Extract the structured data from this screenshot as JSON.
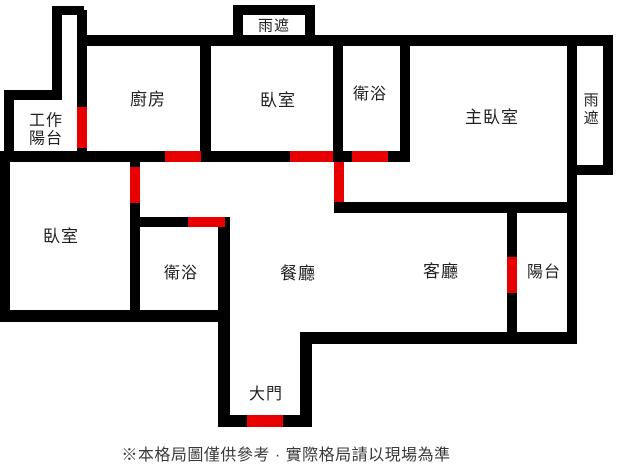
{
  "colors": {
    "wall": "#000000",
    "door_marker": "#e80000",
    "label": "#222222",
    "footer": "#3a3a3a",
    "background": "#ffffff"
  },
  "footer": {
    "note": "※本格局圖僅供參考 · 實際格局請以現場為準"
  },
  "rooms": [
    {
      "id": "work-balcony",
      "label": "工作陽台",
      "cx": 46,
      "cy": 131,
      "font": 16,
      "style": "wrap2"
    },
    {
      "id": "kitchen",
      "label": "廚房",
      "cx": 148,
      "cy": 100,
      "font": 17,
      "style": ""
    },
    {
      "id": "bedroom-top",
      "label": "臥室",
      "cx": 278,
      "cy": 101,
      "font": 17,
      "style": ""
    },
    {
      "id": "bathroom-top",
      "label": "衛浴",
      "cx": 370,
      "cy": 95,
      "font": 16,
      "style": ""
    },
    {
      "id": "master-bedroom",
      "label": "主臥室",
      "cx": 492,
      "cy": 118,
      "font": 17,
      "style": ""
    },
    {
      "id": "rain-canopy-top",
      "label": "雨遮",
      "cx": 274,
      "cy": 26,
      "font": 15,
      "style": ""
    },
    {
      "id": "rain-canopy-right",
      "label": "雨遮",
      "cx": 590,
      "cy": 110,
      "font": 15,
      "style": "vertical"
    },
    {
      "id": "bedroom-left",
      "label": "臥室",
      "cx": 61,
      "cy": 237,
      "font": 17,
      "style": ""
    },
    {
      "id": "bathroom-left",
      "label": "衛浴",
      "cx": 181,
      "cy": 274,
      "font": 16,
      "style": ""
    },
    {
      "id": "dining-room",
      "label": "餐廳",
      "cx": 298,
      "cy": 274,
      "font": 17,
      "style": ""
    },
    {
      "id": "living-room",
      "label": "客廳",
      "cx": 441,
      "cy": 272,
      "font": 17,
      "style": ""
    },
    {
      "id": "balcony",
      "label": "陽台",
      "cx": 544,
      "cy": 273,
      "font": 16,
      "style": ""
    },
    {
      "id": "main-door",
      "label": "大門",
      "cx": 266,
      "cy": 395,
      "font": 16,
      "style": ""
    }
  ],
  "walls": [
    {
      "id": "shaft-top",
      "x": 52,
      "y": 6,
      "w": 32,
      "h": 9
    },
    {
      "id": "shaft-left",
      "x": 52,
      "y": 6,
      "w": 10,
      "h": 94
    },
    {
      "id": "kitchen-left",
      "x": 77,
      "y": 10,
      "w": 10,
      "h": 152
    },
    {
      "id": "work-balcony-top",
      "x": 13,
      "y": 90,
      "w": 49,
      "h": 10
    },
    {
      "id": "outer-left-upper",
      "x": 4,
      "y": 90,
      "w": 10,
      "h": 72
    },
    {
      "id": "outer-left-lower",
      "x": 0,
      "y": 151,
      "w": 10,
      "h": 171
    },
    {
      "id": "top-main",
      "x": 84,
      "y": 35,
      "w": 529,
      "h": 11
    },
    {
      "id": "canopy-top-left",
      "x": 233,
      "y": 5,
      "w": 10,
      "h": 30
    },
    {
      "id": "canopy-top-top",
      "x": 233,
      "y": 5,
      "w": 82,
      "h": 10
    },
    {
      "id": "canopy-top-right",
      "x": 305,
      "y": 5,
      "w": 10,
      "h": 30
    },
    {
      "id": "kitchen-bedroom",
      "x": 200,
      "y": 46,
      "w": 11,
      "h": 105
    },
    {
      "id": "bedroom-bathroom",
      "x": 333,
      "y": 46,
      "w": 10,
      "h": 105
    },
    {
      "id": "bathroom-master",
      "x": 400,
      "y": 46,
      "w": 10,
      "h": 105
    },
    {
      "id": "master-canopy-right",
      "x": 567,
      "y": 44,
      "w": 10,
      "h": 298
    },
    {
      "id": "outer-right",
      "x": 603,
      "y": 35,
      "w": 10,
      "h": 140
    },
    {
      "id": "canopy-right-cap",
      "x": 573,
      "y": 165,
      "w": 40,
      "h": 10
    },
    {
      "id": "mid-horizontal",
      "x": 0,
      "y": 151,
      "w": 410,
      "h": 11
    },
    {
      "id": "bedroomleft-dining",
      "x": 130,
      "y": 151,
      "w": 10,
      "h": 171
    },
    {
      "id": "master-bottom",
      "x": 334,
      "y": 202,
      "w": 243,
      "h": 11
    },
    {
      "id": "bath2-top",
      "x": 135,
      "y": 217,
      "w": 95,
      "h": 10
    },
    {
      "id": "bath2-right",
      "x": 218,
      "y": 217,
      "w": 12,
      "h": 210
    },
    {
      "id": "bottom-left",
      "x": 0,
      "y": 310,
      "w": 228,
      "h": 12
    },
    {
      "id": "entry-bottom",
      "x": 218,
      "y": 415,
      "w": 94,
      "h": 12
    },
    {
      "id": "entry-right",
      "x": 300,
      "y": 333,
      "w": 12,
      "h": 94
    },
    {
      "id": "bottom-right",
      "x": 300,
      "y": 332,
      "w": 277,
      "h": 12
    },
    {
      "id": "balcony-left",
      "x": 507,
      "y": 213,
      "w": 10,
      "h": 129
    }
  ],
  "doors": [
    {
      "id": "work-balcony-door",
      "x": 77,
      "y": 107,
      "w": 10,
      "h": 41
    },
    {
      "id": "kitchen-door",
      "x": 165,
      "y": 151,
      "w": 36,
      "h": 11
    },
    {
      "id": "bedroom-top-door",
      "x": 290,
      "y": 151,
      "w": 43,
      "h": 11
    },
    {
      "id": "bathroom-top-door",
      "x": 352,
      "y": 151,
      "w": 36,
      "h": 11
    },
    {
      "id": "master-door",
      "x": 334,
      "y": 162,
      "w": 10,
      "h": 40
    },
    {
      "id": "bedroom-left-door",
      "x": 130,
      "y": 167,
      "w": 10,
      "h": 36
    },
    {
      "id": "bathroom-left-door",
      "x": 188,
      "y": 217,
      "w": 37,
      "h": 10
    },
    {
      "id": "balcony-door",
      "x": 507,
      "y": 257,
      "w": 10,
      "h": 36
    },
    {
      "id": "main-entrance-door",
      "x": 247,
      "y": 415,
      "w": 36,
      "h": 12
    }
  ]
}
